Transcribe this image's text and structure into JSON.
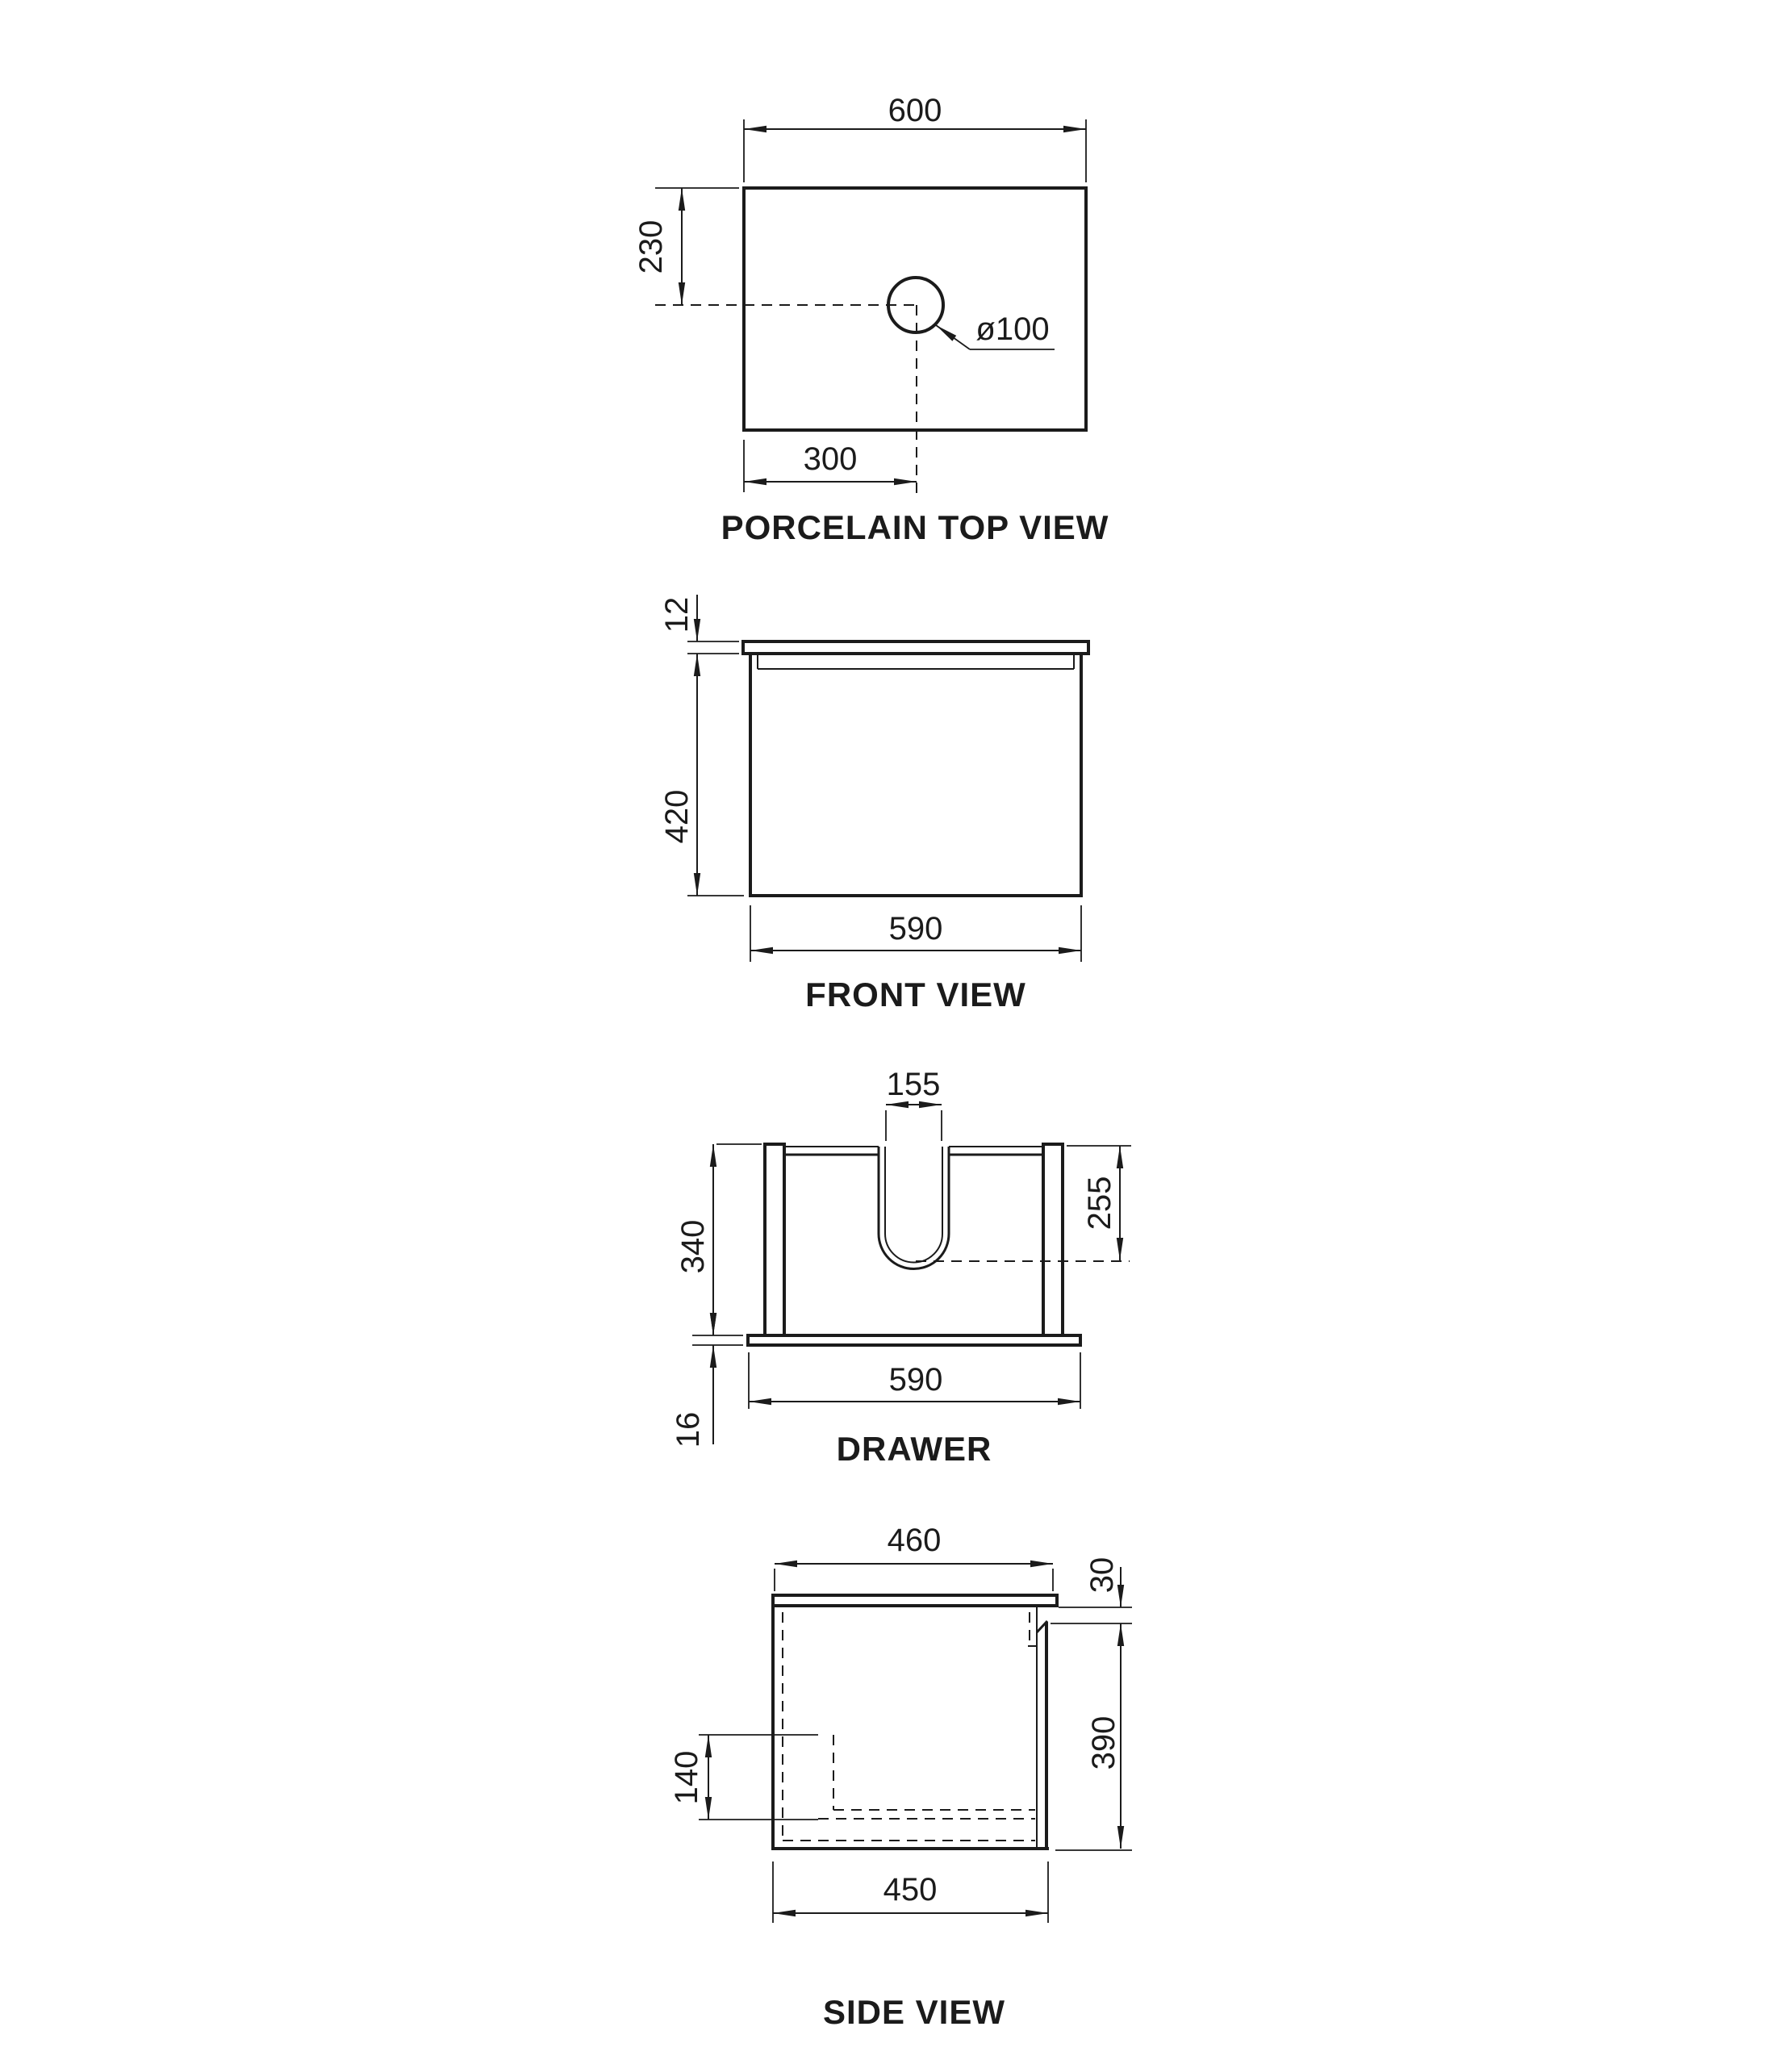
{
  "colors": {
    "ink": "#1b1b1b",
    "background": "#ffffff"
  },
  "views": {
    "top": {
      "title": "PORCELAIN TOP VIEW",
      "dim_width": "600",
      "dim_hole_offset_y": "230",
      "dim_hole_offset_x": "300",
      "dim_hole_diameter": "ø100"
    },
    "front": {
      "title": "FRONT VIEW",
      "dim_top_thickness": "12",
      "dim_height": "420",
      "dim_width": "590"
    },
    "drawer": {
      "title": "DRAWER",
      "dim_cutout_width": "155",
      "dim_height": "340",
      "dim_cutout_depth": "255",
      "dim_base_thickness": "16",
      "dim_width": "590"
    },
    "side": {
      "title": "SIDE VIEW",
      "dim_top_depth": "460",
      "dim_reveal": "30",
      "dim_body_height": "390",
      "dim_inner_height": "140",
      "dim_bottom_depth": "450"
    }
  }
}
